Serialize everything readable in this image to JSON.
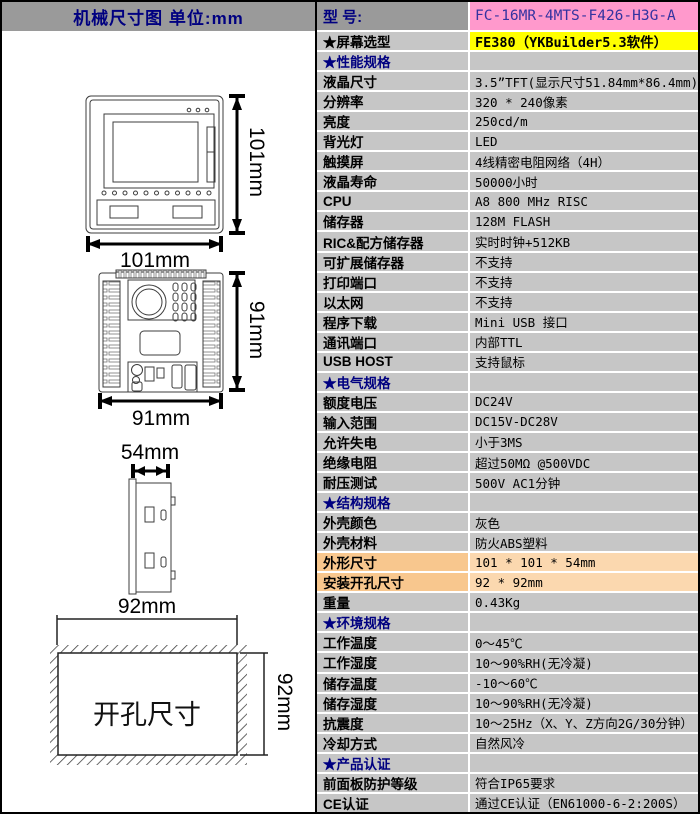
{
  "left_panel": {
    "header_title": "机械尺寸图  单位:mm",
    "front_view": {
      "width_label": "101mm",
      "height_label": "101mm"
    },
    "rear_view": {
      "width_label": "91mm",
      "height_label": "91mm"
    },
    "side_view": {
      "depth_label": "54mm"
    },
    "cutout_view": {
      "width_label": "92mm",
      "height_label": "92mm",
      "caption": "开孔尺寸"
    }
  },
  "spec_table": {
    "model_label": "型  号:",
    "model_value": "FC-16MR-4MTS-F426-H3G-A",
    "rows": [
      {
        "type": "yellow",
        "label": "★屏幕选型",
        "value": "FE380（YKBuilder5.3软件）"
      },
      {
        "type": "section",
        "label": "★性能规格",
        "value": ""
      },
      {
        "type": "data",
        "label": "液晶尺寸",
        "value": "3.5”TFT(显示尺寸51.84mm*86.4mm)"
      },
      {
        "type": "data",
        "label": "分辨率",
        "value": "320 * 240像素"
      },
      {
        "type": "data",
        "label": "亮度",
        "value": "250cd/m"
      },
      {
        "type": "data",
        "label": "背光灯",
        "value": "LED"
      },
      {
        "type": "data",
        "label": "触摸屏",
        "value": "4线精密电阻网络（4H）"
      },
      {
        "type": "data",
        "label": "液晶寿命",
        "value": "50000小时"
      },
      {
        "type": "data",
        "label": "CPU",
        "value": "A8 800 MHz RISC"
      },
      {
        "type": "data",
        "label": "储存器",
        "value": "128M FLASH"
      },
      {
        "type": "data",
        "label": "RIC&配方储存器",
        "value": "实时时钟+512KB"
      },
      {
        "type": "data",
        "label": "可扩展储存器",
        "value": "不支持"
      },
      {
        "type": "data",
        "label": "打印端口",
        "value": "不支持"
      },
      {
        "type": "data",
        "label": "以太网",
        "value": "不支持"
      },
      {
        "type": "data",
        "label": "程序下载",
        "value": "Mini USB 接口"
      },
      {
        "type": "data",
        "label": "通讯端口",
        "value": "内部TTL"
      },
      {
        "type": "data",
        "label": "USB HOST",
        "value": "支持鼠标"
      },
      {
        "type": "section",
        "label": "★电气规格",
        "value": ""
      },
      {
        "type": "data",
        "label": "额度电压",
        "value": "DC24V"
      },
      {
        "type": "data",
        "label": "输入范围",
        "value": "DC15V-DC28V"
      },
      {
        "type": "data",
        "label": "允许失电",
        "value": "小于3MS"
      },
      {
        "type": "data",
        "label": "绝缘电阻",
        "value": "超过50MΩ @500VDC"
      },
      {
        "type": "data",
        "label": "耐压测试",
        "value": "500V AC1分钟"
      },
      {
        "type": "section",
        "label": "★结构规格",
        "value": ""
      },
      {
        "type": "data",
        "label": "外壳颜色",
        "value": "灰色"
      },
      {
        "type": "data",
        "label": "外壳材料",
        "value": "防火ABS塑料"
      },
      {
        "type": "orange",
        "label": "外形尺寸",
        "value": "101 * 101 * 54mm"
      },
      {
        "type": "orange",
        "label": "安装开孔尺寸",
        "value": "92 * 92mm"
      },
      {
        "type": "data",
        "label": "重量",
        "value": "0.43Kg"
      },
      {
        "type": "section",
        "label": "★环境规格",
        "value": ""
      },
      {
        "type": "data",
        "label": "工作温度",
        "value": "0～45℃"
      },
      {
        "type": "data",
        "label": "工作湿度",
        "value": "10～90%RH(无冷凝)"
      },
      {
        "type": "data",
        "label": "储存温度",
        "value": "-10～60℃"
      },
      {
        "type": "data",
        "label": "储存湿度",
        "value": "10～90%RH(无冷凝)"
      },
      {
        "type": "data",
        "label": "抗震度",
        "value": "10～25Hz（X、Y、Z方向2G/30分钟）"
      },
      {
        "type": "data",
        "label": "冷却方式",
        "value": "自然风冷"
      },
      {
        "type": "section",
        "label": "★产品认证",
        "value": ""
      },
      {
        "type": "data",
        "label": "前面板防护等级",
        "value": "符合IP65要求"
      },
      {
        "type": "data",
        "label": "CE认证",
        "value": "通过CE认证（EN61000-6-2:200S）"
      }
    ]
  },
  "colors": {
    "header_gray": "#9A9A9A",
    "model_pink": "#FF99CC",
    "model_text_blue": "#3333A0",
    "highlight_yellow": "#FFFF00",
    "cell_gray": "#C6C6C6",
    "dim_orange_label": "#F8C78E",
    "dim_orange_value": "#FBD8AF",
    "section_navy": "#000080"
  }
}
